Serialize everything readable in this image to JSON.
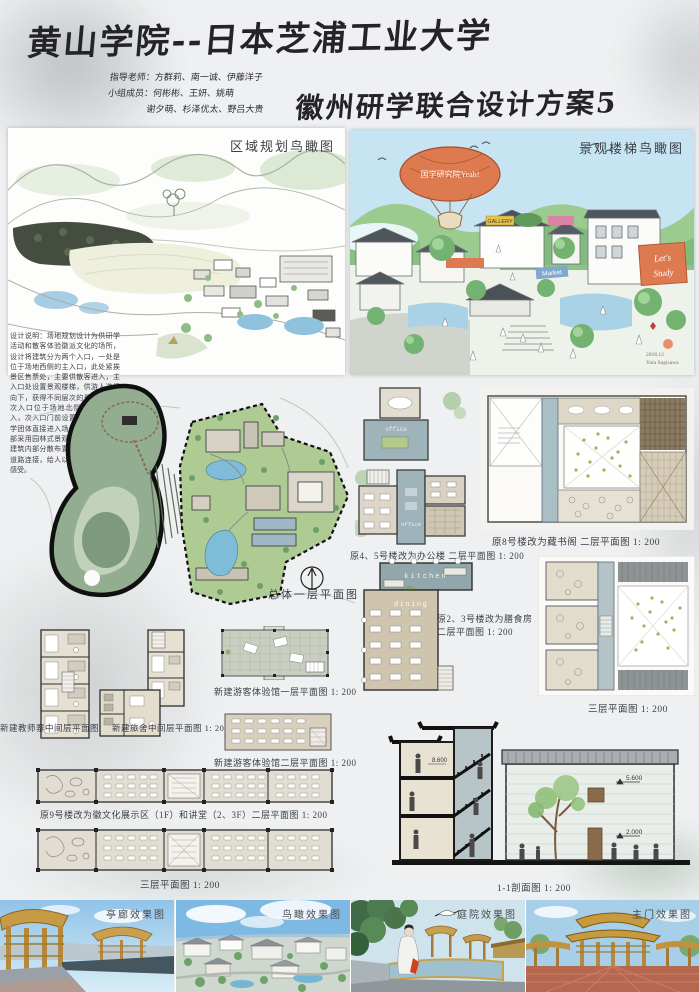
{
  "header": {
    "title": "黄山学院--日本芝浦工业大学",
    "subtitle": "徽州研学联合设计方案5",
    "credits_line1": "指导老师：方群莉、南一诚、伊藤洋子",
    "credits_line2": "小组成员：何彬彬、王妍、姚萌",
    "credits_line3": "谢夕萌、杉泽优太、野吕大贵"
  },
  "aerials": {
    "regional": {
      "title": "区域规划鸟瞰图"
    },
    "stairs": {
      "title": "景观楼梯鸟瞰图",
      "balloon": "国学研究院Yeah!",
      "banner_gallery": "GALLERY",
      "banner_market": "Market",
      "banner_study_line1": "Let's",
      "banner_study_line2": "Study",
      "signature_date": "2018.12",
      "signature_name": "Yuta Sugisawa"
    }
  },
  "design_note": "设计说明：场地规划设计为供研学活动和散客体验徽派文化的场所，设计将建筑分为两个入口，一处是位于场地西侧的主入口，此处紧挨景区售票处，主要供散客进入，主入口处设置景观楼梯，供游人选择向下，获得不同层次的景观体验，次入口位于场地北侧供研学者进入，次入口门前设置停车场方便研学团体直接进入场地内部，场地内部采用园林式景观布置，将前后的建筑内部分散布置并用蜿蜒的景观道路连接，给人以移步换景的空间感受。",
  "plans": {
    "site": {
      "caption": "总体一层平面图"
    },
    "office": {
      "caption": "原4、5号楼改为办公楼 二层平面图 1: 200",
      "room_label": "office"
    },
    "library": {
      "caption": "原8号楼改为藏书阁 二层平面图 1: 200"
    },
    "dining": {
      "caption_line1": "原2、3号楼改为膳食房",
      "caption_line2": "二层平面图 1: 200",
      "kitchen_label": "kitchen",
      "dining_label": "dining"
    },
    "third": {
      "caption": "三层平面图 1: 200"
    },
    "teacher": {
      "caption": "新建教师寨中间层平面图 1: 200"
    },
    "hostel": {
      "caption": "新建旅舍中间层平面图 1: 200"
    },
    "visitor1f": {
      "caption": "新建游客体验馆一层平面图 1: 200"
    },
    "visitor2f": {
      "caption": "新建游客体验馆二层平面图 1: 200"
    },
    "building9_2f": {
      "caption": "原9号楼改为徽文化展示区（1F）和讲堂（2、3F）二层平面图 1: 200"
    },
    "building9_3f": {
      "caption": "三层平面图 1: 200"
    }
  },
  "section": {
    "caption": "1-1剖面图 1: 200",
    "level_top": "8.600",
    "level_mid": "5.600",
    "level_low": "2.000"
  },
  "renderings": {
    "pavilion": "亭廊效果图",
    "aerial": "鸟瞰效果图",
    "courtyard": "庭院效果图",
    "gate": "主门效果图"
  }
}
